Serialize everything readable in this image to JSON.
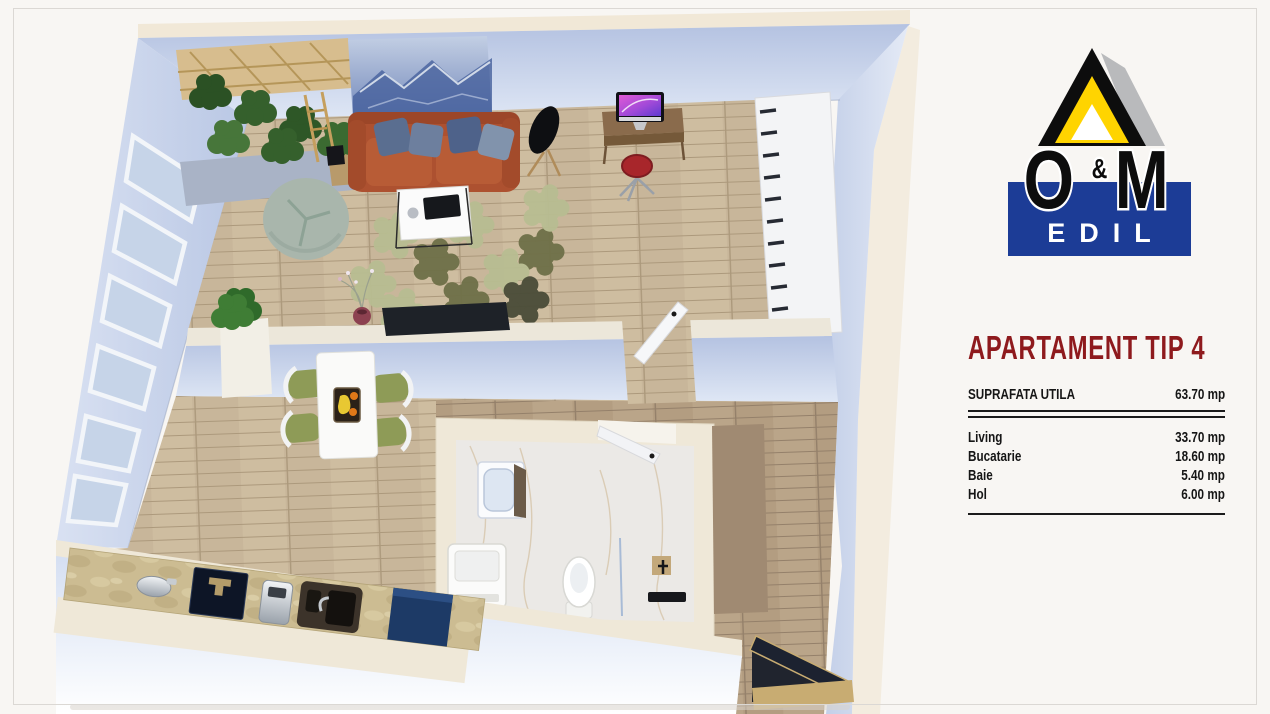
{
  "page": {
    "background": "#f8f6f3",
    "frame_color": "#dbd8d4"
  },
  "brand": {
    "o": "O",
    "ampersand": "&",
    "m": "M",
    "subtitle": "EDIL",
    "colors": {
      "blue": "#1c3c96",
      "yellow": "#ffd400",
      "gray": "#b9babc",
      "black": "#0d0d0d"
    }
  },
  "panel": {
    "title": "APARTAMENT TIP 4",
    "title_color": "#8e1a1d",
    "summary": {
      "label": "SUPRAFATA UTILA",
      "value": "63.70 mp"
    },
    "rooms": [
      {
        "label": "Living",
        "value": "33.70 mp"
      },
      {
        "label": "Bucatarie",
        "value": "18.60 mp"
      },
      {
        "label": "Baie",
        "value": "5.40 mp"
      },
      {
        "label": "Hol",
        "value": "6.00 mp"
      }
    ]
  },
  "floorplan": {
    "palette": {
      "wall_face": "#c7d3ea",
      "wall_top": "#f1e8d7",
      "floor_wood": "#c8b69a",
      "floor_hall": "#b39d81",
      "counter_travertine": "#ccbc92",
      "sofa_orange": "#ad5130",
      "rug_sage": "#b8bd92",
      "rug_olive": "#6e7048",
      "fridge_navy": "#1d3a66",
      "bathroom_marble": "#ebe9e6"
    }
  }
}
